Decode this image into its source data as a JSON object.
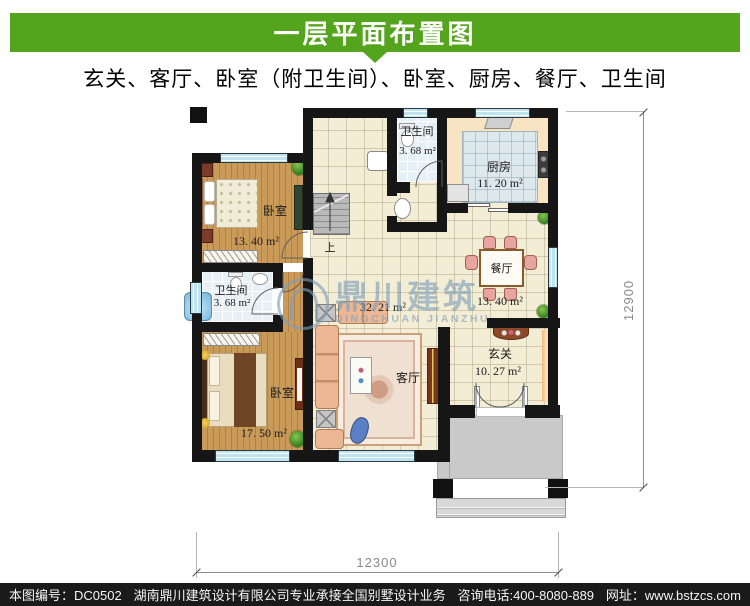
{
  "header": {
    "title": "一层平面布置图",
    "subtitle": "玄关、客厅、卧室（附卫生间）、卧室、厨房、餐厅、卫生间"
  },
  "plan": {
    "rooms": {
      "bedroom_top": {
        "label": "卧室",
        "area": "13. 40 m²"
      },
      "bath_top": {
        "label": "卫生间",
        "area": "3. 68 m²"
      },
      "kitchen": {
        "label": "厨房",
        "area": "11. 20 m²"
      },
      "dining": {
        "label": "餐厅",
        "area": "13. 40 m²"
      },
      "bath_left": {
        "label": "卫生间",
        "area": "3. 68 m²"
      },
      "bedroom_bottom": {
        "label": "卧室",
        "area": "17. 50 m²"
      },
      "living": {
        "label": "客厅",
        "area": "32. 21 m²"
      },
      "entry": {
        "label": "玄关",
        "area": "10. 27 m²"
      }
    },
    "stairs_label": "上",
    "dimensions": {
      "width": "12300",
      "height": "12900"
    }
  },
  "watermark": {
    "cn": "鼎川建筑",
    "en": "DINGCHUAN JIANZHU"
  },
  "footer": {
    "drawing_no": "本图编号：DC0502",
    "company": "湖南鼎川建筑设计有限公司专业承接全国别墅设计业务",
    "phone": "咨询电话:400-8080-889",
    "website": "网址：www.bstzcs.com"
  },
  "colors": {
    "header_green": "#55a41e",
    "footer_black": "#1a1a1a",
    "wall": "#161616",
    "window_cyan": "#bfe4f0",
    "watermark_blue": "#7d9eb9"
  }
}
